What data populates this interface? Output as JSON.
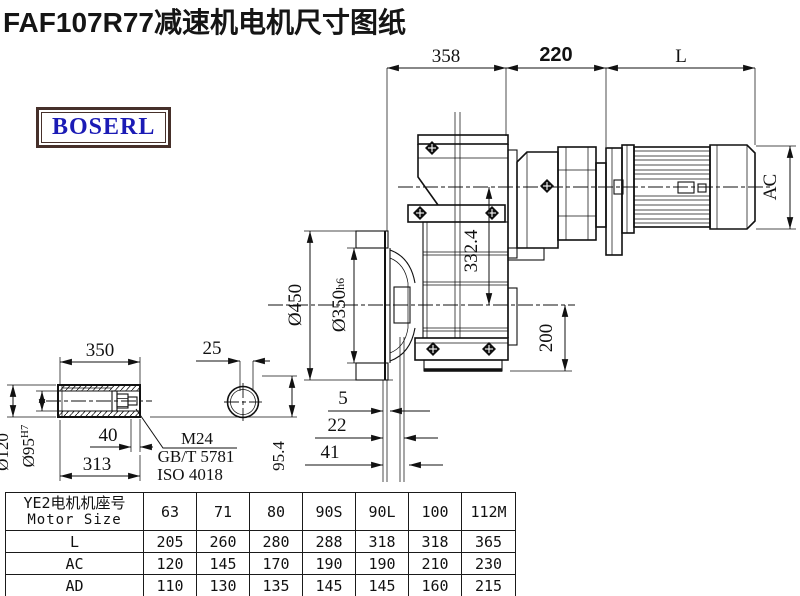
{
  "title": "FAF107R77减速机电机尺寸图纸",
  "logo": {
    "text": "BOSERL"
  },
  "colors": {
    "logo_text": "#1b1bb5",
    "logo_border": "#46302a",
    "line": "#111111"
  },
  "dims": {
    "top": {
      "a": "358",
      "b": "220",
      "c": "L"
    },
    "main": {
      "flange_od": "Ø450",
      "pilot": "Ø350",
      "pilot_tol": "h6",
      "center_height": "332.4",
      "base": "200",
      "ac": "AC",
      "off5": "5",
      "off22": "22",
      "off41": "41"
    },
    "shaft": {
      "len": "350",
      "key_w": "25",
      "depth": "40",
      "bore_depth": "313",
      "od": "Ø120",
      "bore": "Ø95",
      "bore_tol": "H7",
      "height": "95.4",
      "bolt": "M24",
      "std_gb": "GB/T 5781",
      "std_iso": "ISO 4018"
    }
  },
  "table": {
    "header_cn": "YE2电机机座号",
    "header_en": "Motor Size",
    "columns": [
      "63",
      "71",
      "80",
      "90S",
      "90L",
      "100",
      "112M"
    ],
    "rows": [
      {
        "label": "L",
        "values": [
          "205",
          "260",
          "280",
          "288",
          "318",
          "318",
          "365"
        ]
      },
      {
        "label": "AC",
        "values": [
          "120",
          "145",
          "170",
          "190",
          "190",
          "210",
          "230"
        ]
      },
      {
        "label": "AD",
        "values": [
          "110",
          "130",
          "135",
          "145",
          "145",
          "160",
          "215"
        ]
      }
    ]
  }
}
